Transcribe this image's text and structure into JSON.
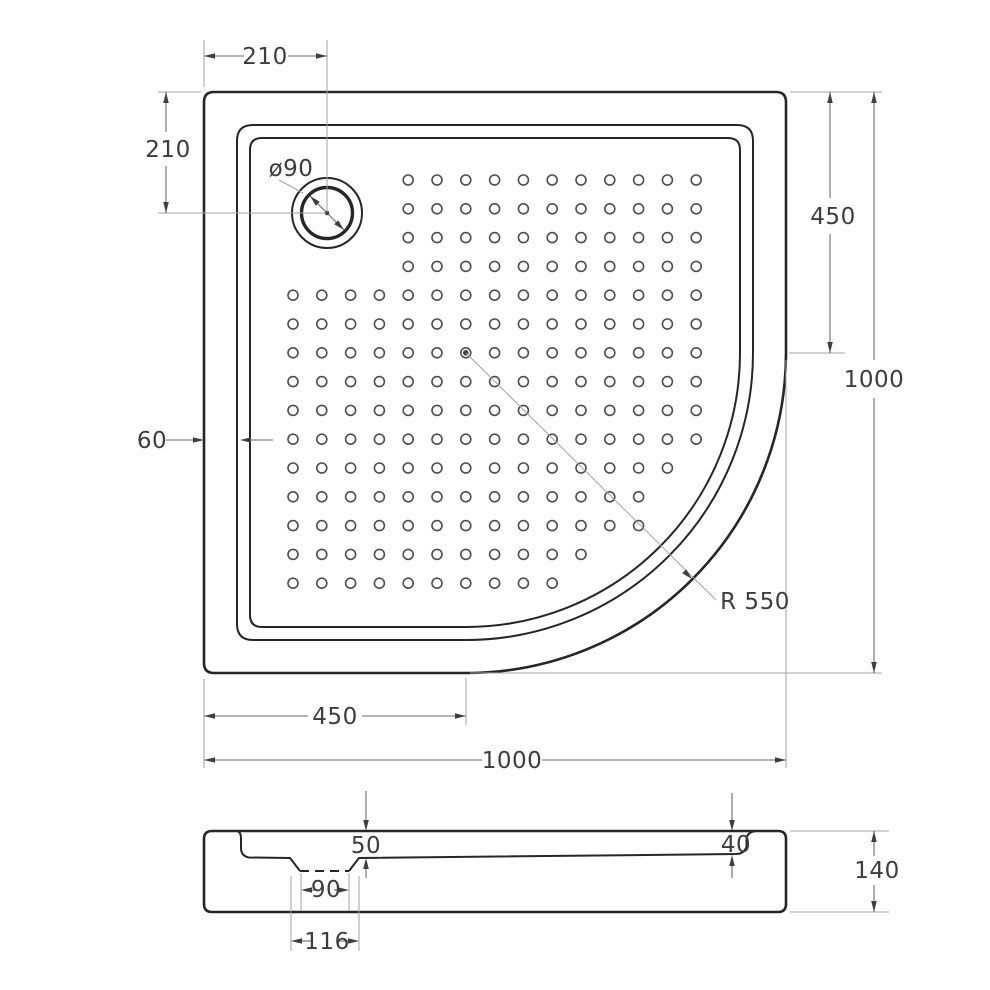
{
  "drawing_title": "quadrant-shower-tray-technical-drawing",
  "top_view": {
    "drain_offset_horizontal": "210",
    "drain_offset_vertical": "210",
    "drain_diameter": "ø90",
    "rim_width": "60",
    "right_edge_straight": "450",
    "overall_depth": "1000",
    "bottom_edge_straight": "450",
    "overall_width": "1000",
    "corner_radius": "R 550"
  },
  "section_view": {
    "depth_at_drain": "50",
    "depth_at_far_end": "40",
    "drain_recess_bottom_width": "90",
    "drain_recess_top_width": "116",
    "overall_height": "140"
  },
  "colors": {
    "part": "#262626",
    "dot": "#4d4d4d",
    "dim_line": "#6b6b6b",
    "extension_line": "#a3a3a3",
    "arrow": "#3f3f3f",
    "text": "#3d3d3d",
    "background": "#ffffff"
  },
  "dot_grid": {
    "rows": 15,
    "cols": 15,
    "spacing": 28.8,
    "x0": 293,
    "y0": 180,
    "radius": 5,
    "top_rows": 4,
    "top_rows_start_col": 5,
    "arc_center": [
      466,
      353
    ],
    "max_center_distance": 246,
    "filled_dot_row_col": [
      7,
      7
    ]
  }
}
